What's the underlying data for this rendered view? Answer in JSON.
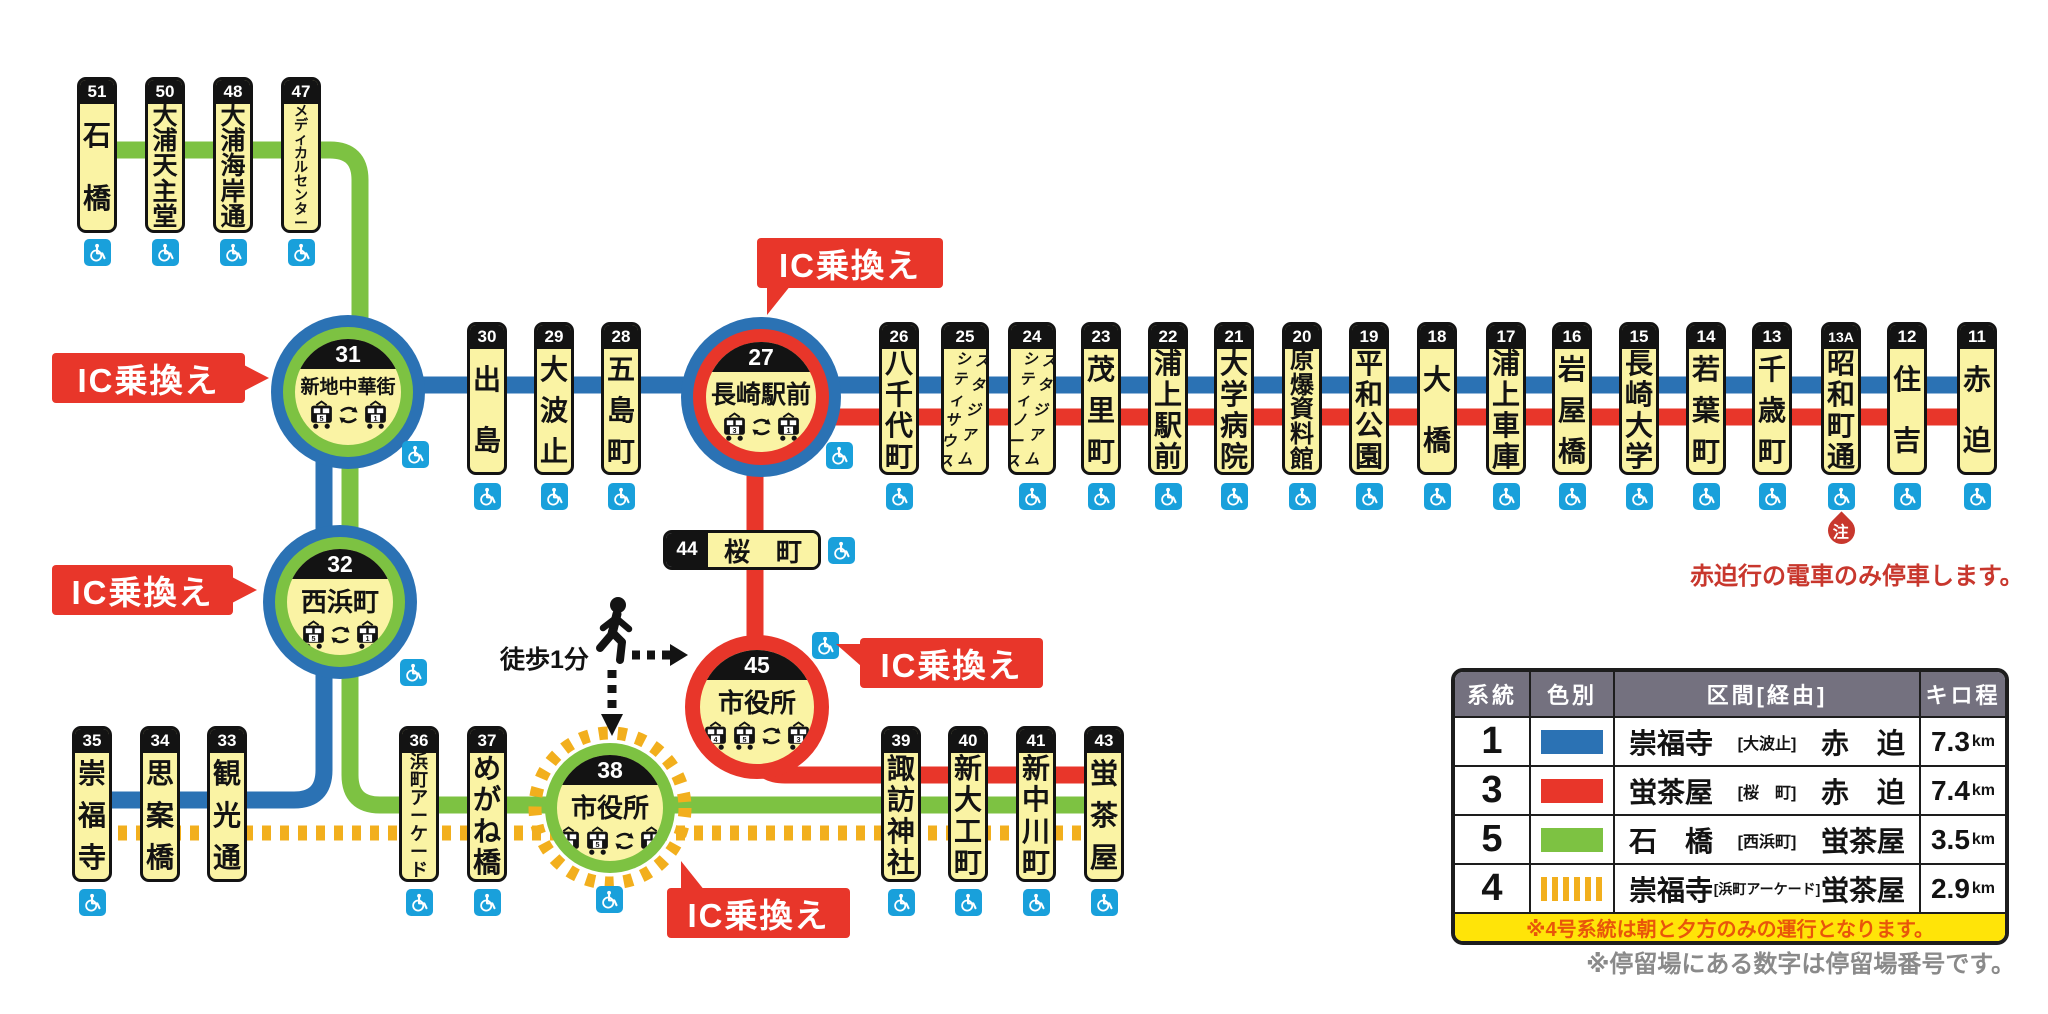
{
  "colors": {
    "blue": "#2b72b4",
    "red": "#e8362a",
    "green": "#7dc242",
    "yellow": "#f2af1d",
    "station_yellow": "#faf3a4",
    "black": "#131313",
    "wheelchair_blue": "#19a0db",
    "legend_header_gray": "#74717f",
    "banner_yellow": "#ffe408",
    "banner_text": "#e8560a",
    "note_red": "#c8372d",
    "footnote_gray": "#8a8a8a"
  },
  "lines": [
    {
      "name": "route5-top",
      "color": "green",
      "width": 17,
      "path": "M97 150 H330 Q360 150 360 180 V340"
    },
    {
      "name": "route1-main",
      "color": "blue",
      "width": 17,
      "path": "M340 385 H1990"
    },
    {
      "name": "route1-south",
      "color": "blue",
      "width": 17,
      "path": "M324 392 V770 Q324 800 294 800 H90"
    },
    {
      "name": "route5-mid",
      "color": "green",
      "width": 17,
      "path": "M350 392 V602"
    },
    {
      "name": "route5-south",
      "color": "green",
      "width": 17,
      "path": "M350 600 V775 Q350 805 380 805 H1120"
    },
    {
      "name": "route3-main",
      "color": "red",
      "width": 17,
      "path": "M761 417 H1990"
    },
    {
      "name": "route3-vertical",
      "color": "red",
      "width": 17,
      "path": "M755 395 V660"
    },
    {
      "name": "route3-south",
      "color": "red",
      "width": 17,
      "path": "M755 695 V745 Q755 775 785 775 H1120"
    },
    {
      "name": "route4-dashed",
      "color": "yellow",
      "width": 15,
      "dash": "9 9",
      "path": "M100 833 H1120"
    }
  ],
  "rows": {
    "top": {
      "top": 77,
      "numH": 24,
      "labelH": 132,
      "wcY": 239
    },
    "main": {
      "top": 322,
      "numH": 24,
      "labelH": 129,
      "wcY": 483
    },
    "bottom": {
      "top": 726,
      "numH": 24,
      "labelH": 132,
      "wcY": 889
    }
  },
  "stations": [
    {
      "id": "51",
      "name": "石橋",
      "x": 97,
      "row": "top",
      "wc": true
    },
    {
      "id": "50",
      "name": "大浦天主堂",
      "x": 165,
      "row": "top",
      "wc": true
    },
    {
      "id": "48",
      "name": "大浦海岸通",
      "x": 233,
      "row": "top",
      "wc": true
    },
    {
      "id": "47",
      "name": "メディカルセンター",
      "x": 301,
      "row": "top",
      "wc": true
    },
    {
      "id": "30",
      "name": "出島",
      "x": 487,
      "row": "main",
      "wc": true
    },
    {
      "id": "29",
      "name": "大波止",
      "x": 554,
      "row": "main",
      "wc": true
    },
    {
      "id": "28",
      "name": "五島町",
      "x": 621,
      "row": "main",
      "wc": true
    },
    {
      "id": "26",
      "name": "八千代町",
      "x": 899,
      "row": "main",
      "wc": true
    },
    {
      "id": "25",
      "name": "スタジアムシティサウス",
      "x": 965,
      "row": "main",
      "wc": false,
      "two_col": [
        "スタジアム",
        "シティサウス"
      ]
    },
    {
      "id": "24",
      "name": "スタジアムシティノース",
      "x": 1032,
      "row": "main",
      "wc": true,
      "two_col": [
        "スタジアム",
        "シティノース"
      ]
    },
    {
      "id": "23",
      "name": "茂里町",
      "x": 1101,
      "row": "main",
      "wc": true
    },
    {
      "id": "22",
      "name": "浦上駅前",
      "x": 1168,
      "row": "main",
      "wc": true
    },
    {
      "id": "21",
      "name": "大学病院",
      "x": 1234,
      "row": "main",
      "wc": true
    },
    {
      "id": "20",
      "name": "原爆資料館",
      "x": 1302,
      "row": "main",
      "wc": true
    },
    {
      "id": "19",
      "name": "平和公園",
      "x": 1369,
      "row": "main",
      "wc": true
    },
    {
      "id": "18",
      "name": "大橋",
      "x": 1437,
      "row": "main",
      "wc": true
    },
    {
      "id": "17",
      "name": "浦上車庫",
      "x": 1506,
      "row": "main",
      "wc": true
    },
    {
      "id": "16",
      "name": "岩屋橋",
      "x": 1572,
      "row": "main",
      "wc": true
    },
    {
      "id": "15",
      "name": "長崎大学",
      "x": 1639,
      "row": "main",
      "wc": true
    },
    {
      "id": "14",
      "name": "若葉町",
      "x": 1706,
      "row": "main",
      "wc": true
    },
    {
      "id": "13",
      "name": "千歳町",
      "x": 1772,
      "row": "main",
      "wc": true
    },
    {
      "id": "13A",
      "name": "昭和町通",
      "x": 1841,
      "row": "main",
      "wc": true
    },
    {
      "id": "12",
      "name": "住吉",
      "x": 1907,
      "row": "main",
      "wc": true
    },
    {
      "id": "11",
      "name": "赤迫",
      "x": 1977,
      "row": "main",
      "wc": true
    },
    {
      "id": "35",
      "name": "崇福寺",
      "x": 92,
      "row": "bottom",
      "wc": true
    },
    {
      "id": "34",
      "name": "思案橋",
      "x": 160,
      "row": "bottom",
      "wc": false
    },
    {
      "id": "33",
      "name": "観光通",
      "x": 227,
      "row": "bottom",
      "wc": false
    },
    {
      "id": "36",
      "name": "浜町アーケード",
      "x": 419,
      "row": "bottom",
      "wc": true
    },
    {
      "id": "37",
      "name": "めがね橋",
      "x": 487,
      "row": "bottom",
      "wc": true
    },
    {
      "id": "39",
      "name": "諏訪神社",
      "x": 901,
      "row": "bottom",
      "wc": true
    },
    {
      "id": "40",
      "name": "新大工町",
      "x": 968,
      "row": "bottom",
      "wc": true
    },
    {
      "id": "41",
      "name": "新中川町",
      "x": 1036,
      "row": "bottom",
      "wc": true
    },
    {
      "id": "43",
      "name": "蛍茶屋",
      "x": 1104,
      "row": "bottom",
      "wc": true
    }
  ],
  "hubs": [
    {
      "id": "31",
      "name": "新地中華街",
      "cx": 348,
      "cy": 392,
      "yellow_d": 106,
      "inner": {
        "color": "green",
        "w": 12
      },
      "outer": {
        "color": "blue",
        "w": 12
      },
      "trams": [
        "5",
        "arrow",
        "1"
      ],
      "wc": {
        "x": 402,
        "y": 441
      }
    },
    {
      "id": "27",
      "name": "長崎駅前",
      "cx": 761,
      "cy": 397,
      "yellow_d": 110,
      "inner": {
        "color": "red",
        "w": 13
      },
      "outer": {
        "color": "blue",
        "w": 12
      },
      "trams": [
        "3",
        "arrow",
        "1"
      ],
      "wc": {
        "x": 826,
        "y": 442
      }
    },
    {
      "id": "32",
      "name": "西浜町",
      "cx": 340,
      "cy": 602,
      "yellow_d": 106,
      "inner": {
        "color": "green",
        "w": 12
      },
      "outer": {
        "color": "blue",
        "w": 12
      },
      "trams": [
        "5",
        "arrow",
        "1"
      ],
      "wc": {
        "x": 400,
        "y": 659
      }
    },
    {
      "id": "45",
      "name": "市役所",
      "cx": 757,
      "cy": 707,
      "yellow_d": 114,
      "inner": {
        "color": "red",
        "w": 15
      },
      "outer": null,
      "trams": [
        "4",
        "5",
        "arrow",
        "3"
      ],
      "wc": {
        "x": 812,
        "y": 632
      }
    },
    {
      "id": "38",
      "name": "市役所",
      "cx": 610,
      "cy": 808,
      "yellow_d": 106,
      "inner": {
        "color": "green",
        "w": 12
      },
      "outer": null,
      "dashed_halo": true,
      "trams": [
        "4",
        "5",
        "arrow",
        "3"
      ],
      "wc": {
        "x": 596,
        "y": 886
      }
    }
  ],
  "station44": {
    "id": "44",
    "name_left": "桜",
    "name_right": "町",
    "x": 663,
    "y": 530,
    "w": 158,
    "h": 40,
    "wc": {
      "x": 828,
      "y": 537
    }
  },
  "ic_badges": [
    {
      "name": "ic-badge-shinchi",
      "label": "IC乗換え",
      "x": 52,
      "y": 353,
      "w": 193,
      "h": 50,
      "dir": "right"
    },
    {
      "name": "ic-badge-nagasakieki",
      "label": "IC乗換え",
      "x": 757,
      "y": 238,
      "w": 186,
      "h": 50,
      "dir": "down-left"
    },
    {
      "name": "ic-badge-nishihamanomachi",
      "label": "IC乗換え",
      "x": 52,
      "y": 565,
      "w": 181,
      "h": 50,
      "dir": "right"
    },
    {
      "name": "ic-badge-shiyakusho45",
      "label": "IC乗換え",
      "x": 860,
      "y": 638,
      "w": 183,
      "h": 50,
      "dir": "left"
    },
    {
      "name": "ic-badge-shiyakusho38",
      "label": "IC乗換え",
      "x": 667,
      "y": 888,
      "w": 183,
      "h": 50,
      "dir": "up-left"
    }
  ],
  "walk": {
    "label": "徒歩1分"
  },
  "note_right": {
    "mark": "注",
    "text": "赤迫行の電車のみ停車します。"
  },
  "legend": {
    "headers": [
      "系統",
      "色別",
      "区間[経由]",
      "キロ程"
    ],
    "rows": [
      {
        "route": "1",
        "color": "blue",
        "swatch": "solid",
        "origin": "崇福寺",
        "via": "[大波止]",
        "dest": "赤　迫",
        "dist": "7.3",
        "unit": "km"
      },
      {
        "route": "3",
        "color": "red",
        "swatch": "solid",
        "origin": "蛍茶屋",
        "via": "[桜　町]",
        "dest": "赤　迫",
        "dist": "7.4",
        "unit": "km"
      },
      {
        "route": "5",
        "color": "green",
        "swatch": "solid",
        "origin": "石　橋",
        "via": "[西浜町]",
        "dest": "蛍茶屋",
        "dist": "3.5",
        "unit": "km"
      },
      {
        "route": "4",
        "color": "yellow",
        "swatch": "dashed",
        "origin": "崇福寺",
        "via": "[浜町アーケード]",
        "dest": "蛍茶屋",
        "dist": "2.9",
        "unit": "km"
      }
    ],
    "banner": "※4号系統は朝と夕方のみの運行となります。",
    "footnote": "※停留場にある数字は停留場番号です。"
  }
}
